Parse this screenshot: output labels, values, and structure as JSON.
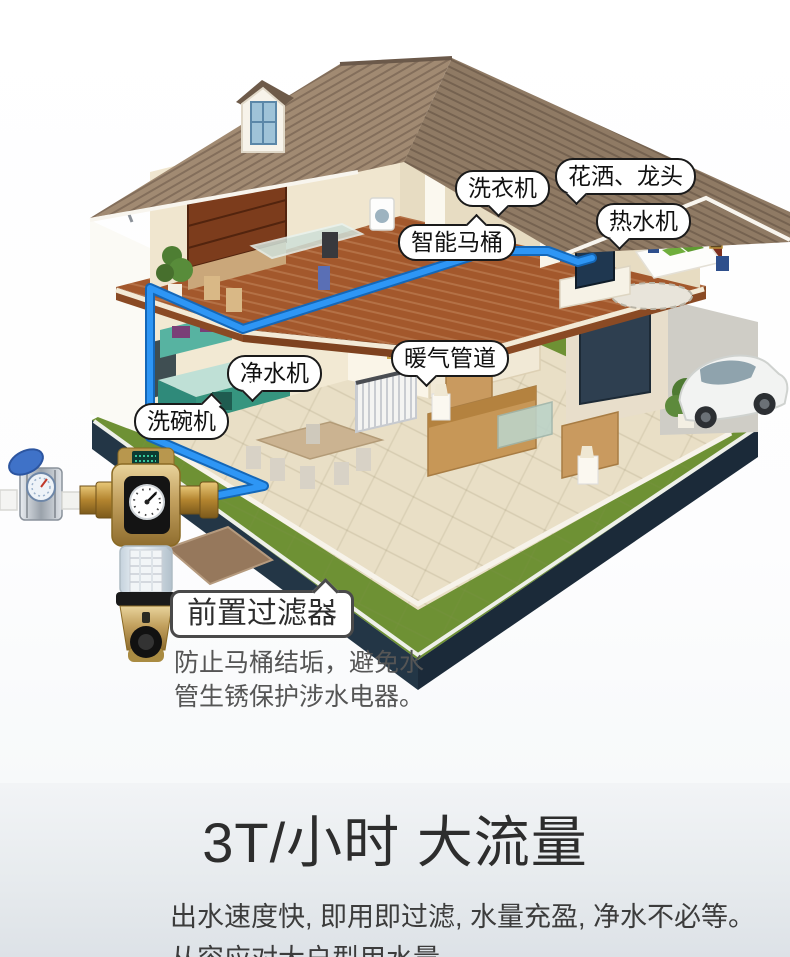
{
  "scene": {
    "callouts": {
      "washer": "洗衣机",
      "shower_faucet": "花洒、龙头",
      "water_heater": "热水机",
      "smart_toilet": "智能马桶",
      "heating_pipes": "暖气管道",
      "water_purifier": "净水机",
      "dishwasher": "洗碗机"
    },
    "icons": {
      "house": "isometric-cutaway-house",
      "pipe": "blue-water-pipe-line",
      "device": "pre-filter-water-device",
      "gauge": "pressure-gauge",
      "meter": "water-meter-with-blue-cap",
      "car": "white-sedan",
      "dormer": "dormer-window",
      "satellite": "satellite-dish"
    }
  },
  "prefilter": {
    "title": "前置过滤器",
    "desc_line1": "防止马桶结垢，避免水",
    "desc_line2": "管生锈保护涉水电器。"
  },
  "bottom_section": {
    "title": "3T/小时 大流量",
    "subtitle": "出水速度快, 即用即过滤, 水量充盈, 净水不必等。",
    "subtitle2": "从容应对大户型用水量"
  },
  "colors": {
    "pipe_blue": "#1b85e8",
    "roof_brown": "#96816b",
    "lawn_green": "#6e9134",
    "base_navy": "#233646",
    "device_gold": "#c2a05e",
    "callout_border": "#1a1a1a",
    "headline_text": "#2d2d2d",
    "section_bg_top": "#f2f4f6",
    "section_bg_bottom": "#dde2e7"
  }
}
